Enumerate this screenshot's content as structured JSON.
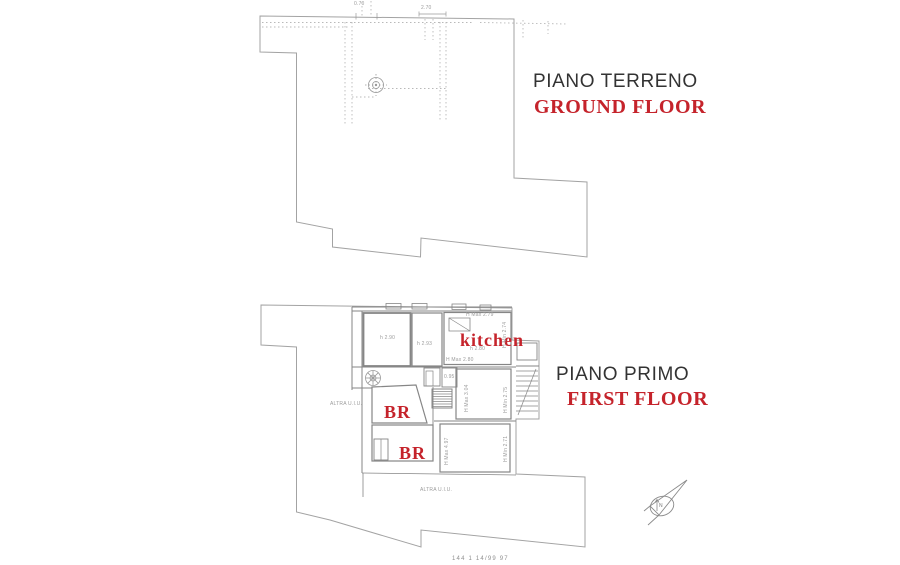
{
  "document": {
    "kind": "cadastral floor plan sheet",
    "background": "#ffffff"
  },
  "colors": {
    "accent_red": "#c5232b",
    "outline": "#a3a3a3",
    "wall": "#868686",
    "dotted": "#b9b9b9",
    "faint_text": "#9c9c9c"
  },
  "ground_floor": {
    "title_it": "PIANO TERRENO",
    "title_en": "GROUND FLOOR",
    "dim_top": "2.70",
    "dim_top_small": "0.70"
  },
  "first_floor": {
    "title_it": "PIANO PRIMO",
    "title_en": "FIRST FLOOR",
    "room_labels": {
      "kitchen": "kitchen",
      "bedroom1": "BR",
      "bedroom2": "BR"
    },
    "annotations": {
      "room1_height": "h 2.90",
      "room2_height": "h 2.93",
      "kitchen_hmax": "H Max 2.79",
      "kitchen_h": "h 2.80",
      "kitchen_hmin": "H Min 2.74",
      "kitchen_hmax2": "H Max 2.80",
      "hall_width": "0.95",
      "roomC_hmax": "H Max 3.04",
      "roomC_hmin": "H Min 2.75",
      "roomD_hmax": "H Max 4.97",
      "roomD_hmin": "H Min 2.71",
      "other_unit_left": "ALTRA U.I.U.",
      "other_unit_bottom": "ALTRA U.I.U."
    }
  },
  "compass": {
    "label": "N"
  },
  "footer": {
    "text": "144 1 14/99 97"
  }
}
